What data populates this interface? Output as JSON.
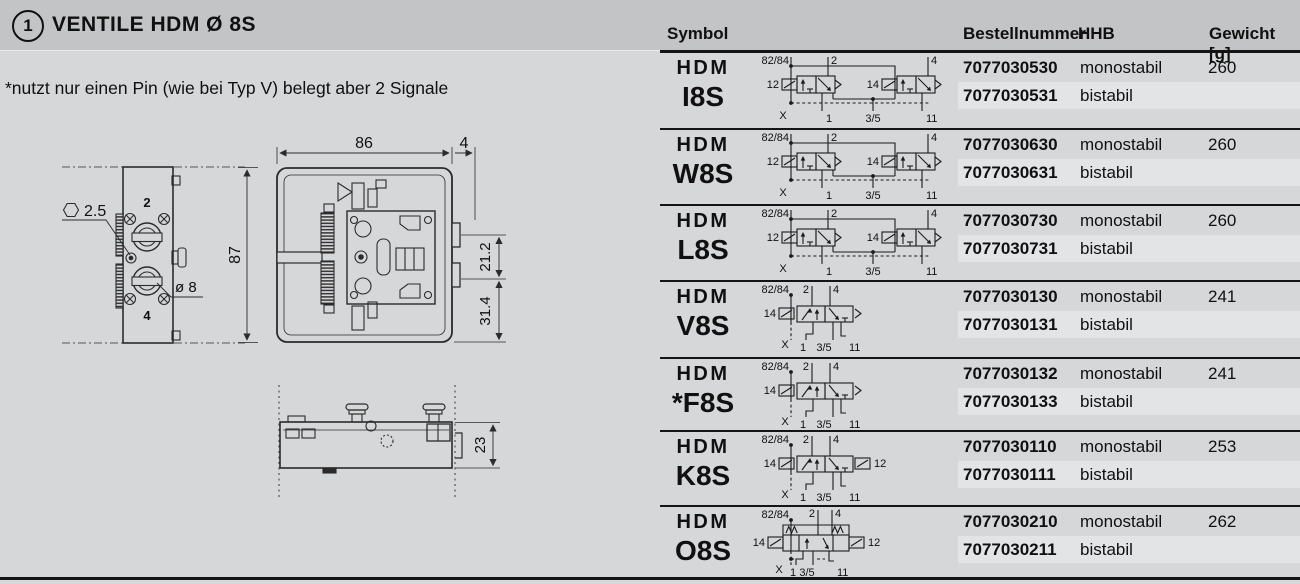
{
  "header": {
    "badge": "1",
    "title": "VENTILE  HDM  Ø 8S",
    "columns": {
      "symbol": "Symbol",
      "order": "Bestellnummer",
      "hhb": "HHB",
      "weight": "Gewicht [g]"
    }
  },
  "note": "*nutzt nur einen Pin (wie bei Typ V) belegt aber 2 Signale",
  "drawing": {
    "dim_width": "86",
    "dim_tab": "4",
    "dim_height": "87",
    "dim_upper": "21.2",
    "dim_lower": "31.4",
    "dim_side_height": "23",
    "hex_size": "2.5",
    "dia_port": "ø 8",
    "port_top": "2",
    "port_bottom": "4"
  },
  "colors": {
    "topbar": "#c3c4c6",
    "page": "#d6d7d9",
    "alt_band": "#e3e4e6",
    "line": "#141414"
  },
  "rows": [
    {
      "brand": "HDM",
      "model": "I8S",
      "sym": "double",
      "labels": {
        "tl": "82/84",
        "t1": "2",
        "t2": "4",
        "l1": "12",
        "l2": "14",
        "bl": "X",
        "b1": "1",
        "b2": "3/5",
        "b3": "11"
      },
      "orders": [
        {
          "nr": "7077030530",
          "hhb": "monostabil",
          "wt": "260"
        },
        {
          "nr": "7077030531",
          "hhb": "bistabil",
          "wt": ""
        }
      ]
    },
    {
      "brand": "HDM",
      "model": "W8S",
      "sym": "double",
      "labels": {
        "tl": "82/84",
        "t1": "2",
        "t2": "4",
        "l1": "12",
        "l2": "14",
        "bl": "X",
        "b1": "1",
        "b2": "3/5",
        "b3": "11"
      },
      "orders": [
        {
          "nr": "7077030630",
          "hhb": "monostabil",
          "wt": "260"
        },
        {
          "nr": "7077030631",
          "hhb": "bistabil",
          "wt": ""
        }
      ]
    },
    {
      "brand": "HDM",
      "model": "L8S",
      "sym": "double",
      "labels": {
        "tl": "82/84",
        "t1": "2",
        "t2": "4",
        "l1": "12",
        "l2": "14",
        "bl": "X",
        "b1": "1",
        "b2": "3/5",
        "b3": "11"
      },
      "orders": [
        {
          "nr": "7077030730",
          "hhb": "monostabil",
          "wt": "260"
        },
        {
          "nr": "7077030731",
          "hhb": "bistabil",
          "wt": ""
        }
      ]
    },
    {
      "brand": "HDM",
      "model": "V8S",
      "sym": "single",
      "labels": {
        "tl": "82/84",
        "t1": "2",
        "t2": "4",
        "l1": "14",
        "bl": "X",
        "b1": "1",
        "b2": "3/5",
        "b3": "11"
      },
      "orders": [
        {
          "nr": "7077030130",
          "hhb": "monostabil",
          "wt": "241"
        },
        {
          "nr": "7077030131",
          "hhb": "bistabil",
          "wt": ""
        }
      ]
    },
    {
      "brand": "HDM",
      "model": "*F8S",
      "sym": "single",
      "labels": {
        "tl": "82/84",
        "t1": "2",
        "t2": "4",
        "l1": "14",
        "bl": "X",
        "b1": "1",
        "b2": "3/5",
        "b3": "11"
      },
      "orders": [
        {
          "nr": "7077030132",
          "hhb": "monostabil",
          "wt": "241"
        },
        {
          "nr": "7077030133",
          "hhb": "bistabil",
          "wt": ""
        }
      ]
    },
    {
      "brand": "HDM",
      "model": "K8S",
      "sym": "singleK",
      "labels": {
        "tl": "82/84",
        "t1": "2",
        "t2": "4",
        "l1": "14",
        "r1": "12",
        "bl": "X",
        "b1": "1",
        "b2": "3/5",
        "b3": "11"
      },
      "orders": [
        {
          "nr": "7077030110",
          "hhb": "monostabil",
          "wt": "253"
        },
        {
          "nr": "7077030111",
          "hhb": "bistabil",
          "wt": ""
        }
      ]
    },
    {
      "brand": "HDM",
      "model": "O8S",
      "sym": "springs",
      "labels": {
        "tl": "82/84",
        "t1": "2",
        "t2": "4",
        "l1": "14",
        "r1": "12",
        "bl": "X",
        "b1": "1",
        "b2": "3/5",
        "b3": "11"
      },
      "orders": [
        {
          "nr": "7077030210",
          "hhb": "monostabil",
          "wt": "262"
        },
        {
          "nr": "7077030211",
          "hhb": "bistabil",
          "wt": ""
        }
      ]
    }
  ]
}
